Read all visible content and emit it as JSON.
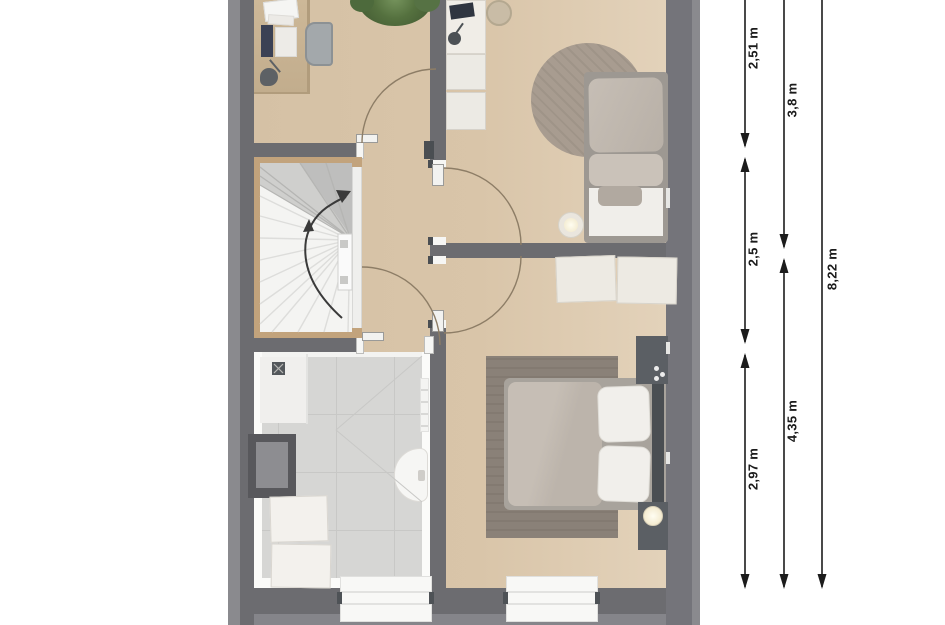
{
  "plan": {
    "type": "floor-plan-top-view",
    "palette": {
      "page_background": "#ffffff",
      "exterior_band": "#85858a",
      "wall": "#6c6c70",
      "floor_beige": "#d8c4a8",
      "bathroom_tile": "#d6d6d4",
      "stair_tread": "#f4f4f2",
      "wood_trim": "#c2a37c",
      "door_arc": "#8d7d66",
      "dimension_ink": "#1c1c1c"
    }
  },
  "dimensions": {
    "col1": {
      "top": "2,51 m",
      "middle": "2,5 m",
      "bottom": "2,97 m"
    },
    "col2": {
      "top": "3,8 m",
      "bottom": "4,35 m"
    },
    "col3": {
      "total": "8,22 m"
    }
  }
}
